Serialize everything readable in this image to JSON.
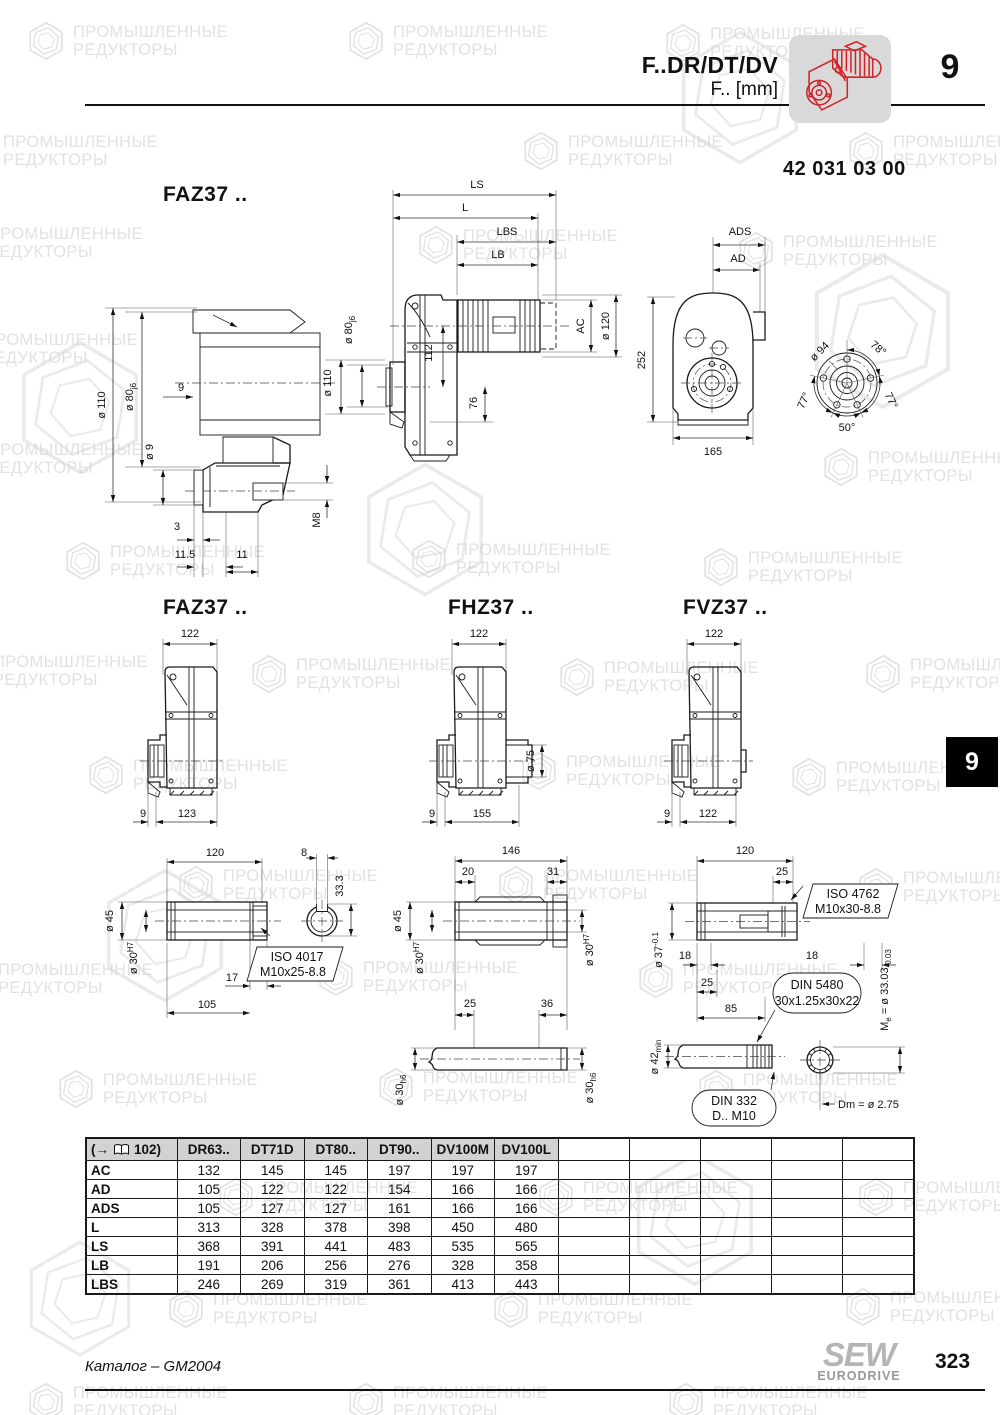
{
  "header": {
    "product": "F..DR/DT/DV",
    "unit_line": "F.. [mm]",
    "chapter": "9",
    "doc_number": "42 031 03 00"
  },
  "watermark": {
    "line1": "ПРОМЫШЛЕННЫЕ",
    "line2": "РЕДУКТОРЫ"
  },
  "titles": {
    "main": "FAZ37 ..",
    "faz": "FAZ37 ..",
    "fhz": "FHZ37 ..",
    "fvz": "FVZ37 .."
  },
  "dims": {
    "hub": {
      "d110": "ø 110",
      "d80": "ø 80",
      "j6": "j6",
      "gap9": "9",
      "d9": "ø 9",
      "m8": "M8",
      "n3": "3",
      "n115": "11.5",
      "n11": "11"
    },
    "side": {
      "ls": "LS",
      "l": "L",
      "lbs": "LBS",
      "lb": "LB",
      "d80": "ø 80",
      "j6": "j6",
      "d110": "ø 110",
      "n112": "112",
      "n76": "76",
      "ac": "AC",
      "d120": "ø 120"
    },
    "front": {
      "ads": "ADS",
      "ad": "AD",
      "n252": "252",
      "n165": "165",
      "d94": "ø 94",
      "a78": "78°",
      "a77r": "77°",
      "a77l": "77°",
      "a50": "50°"
    },
    "faz": {
      "top": "122",
      "off": "9",
      "base": "123"
    },
    "fhz": {
      "top": "122",
      "off": "9",
      "base": "155",
      "d75": "ø 75"
    },
    "fvz": {
      "top": "122",
      "off": "9",
      "base": "122"
    },
    "s1": {
      "len": "120",
      "key_w": "8",
      "key_d": "33.3",
      "d45": "ø 45",
      "d30": "ø 30",
      "h7": "H7",
      "n17": "17",
      "n105": "105",
      "iso": "ISO 4017",
      "iso2": "M10x25-8.8"
    },
    "s2": {
      "len": "146",
      "n20": "20",
      "n31": "31",
      "d45": "ø 45",
      "d30": "ø 30",
      "h7": "H7",
      "n25": "25",
      "n36": "36",
      "h6": "h6"
    },
    "s3": {
      "len": "120",
      "n25top": "25",
      "iso": "ISO 4762",
      "iso2": "M10x30-8.8",
      "d37": "ø 37",
      "t01": "-0.1",
      "n18l": "18",
      "n18r": "18",
      "n25": "25",
      "n85": "85",
      "din5480": "DIN 5480",
      "din5480b": "30x1.25x30x22",
      "me1": "M",
      "me_sub": "e",
      "me2": " = ø 33.03",
      "me_tol": "-0.03",
      "d42": "ø 42",
      "min": "min",
      "din332": "DIN 332",
      "din332b": "D.. M10",
      "dm": "Dm = ø 2.75"
    }
  },
  "table": {
    "ref_open": "(→",
    "ref_page": "102)",
    "columns": [
      "DR63..",
      "DT71D",
      "DT80..",
      "DT90..",
      "DV100M",
      "DV100L"
    ],
    "rows": [
      {
        "label": "AC",
        "values": [
          "132",
          "145",
          "145",
          "197",
          "197",
          "197"
        ]
      },
      {
        "label": "AD",
        "values": [
          "105",
          "122",
          "122",
          "154",
          "166",
          "166"
        ]
      },
      {
        "label": "ADS",
        "values": [
          "105",
          "127",
          "127",
          "161",
          "166",
          "166"
        ]
      },
      {
        "label": "L",
        "values": [
          "313",
          "328",
          "378",
          "398",
          "450",
          "480"
        ]
      },
      {
        "label": "LS",
        "values": [
          "368",
          "391",
          "441",
          "483",
          "535",
          "565"
        ]
      },
      {
        "label": "LB",
        "values": [
          "191",
          "206",
          "256",
          "276",
          "328",
          "358"
        ]
      },
      {
        "label": "LBS",
        "values": [
          "246",
          "269",
          "319",
          "361",
          "413",
          "443"
        ]
      }
    ]
  },
  "footer": {
    "catalog": "Каталог – GM2004",
    "brand_top": "SEW",
    "brand_bottom": "EURODRIVE",
    "page": "323"
  },
  "side_tab": {
    "chapter": "9"
  }
}
